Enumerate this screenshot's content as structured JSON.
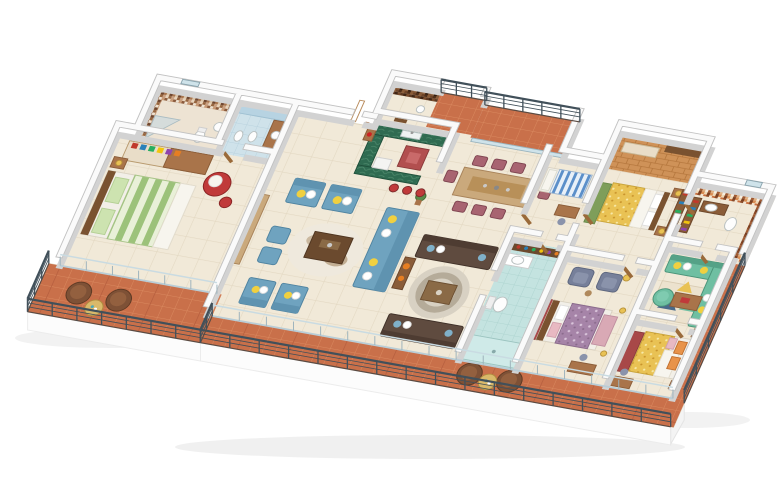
{
  "scene": {
    "title": "3D isometric apartment floor plan render",
    "background": "#ffffff",
    "palette": {
      "wallTop": "#fafafa",
      "wallEdge": "#c2c2c2",
      "wallSide": "#d2d2d2",
      "floorBeige": "#f1e9d8",
      "floorGrout": "#e3d8c2",
      "terracotta": "#c9704a",
      "terracottaLine": "#da8a60",
      "terracottaBig": "#b2593a",
      "aquaFloor": "#c4e3e0",
      "blueTile": "#cfe2ea",
      "railing": "#41505a",
      "glass": "#9fb4bd",
      "wood": "#a9744a",
      "woodDark": "#7a5230",
      "woodLight": "#caa97c",
      "cream": "#e9ddc8",
      "greenCounter": "#2f6b51",
      "redIsland": "#b24f4f",
      "applianceWhite": "#f4f4f2",
      "sofaBlue": "#6fa3bf",
      "sofaBlueDark": "#5f93b0",
      "sofaBrown": "#5f4b3f",
      "sofaBrownDark": "#4e3c32",
      "sofaTeal": "#6fbfa2",
      "sofaTealDark": "#55a287",
      "chairMaroon": "#a86471",
      "chairGray": "#77809a",
      "chairRed": "#c03a3a",
      "loungeBrown": "#7e5136",
      "patioTable": "#d9b96a",
      "bedGreenLight": "#e9f0d8",
      "bedGreenBand": "#9cc27a",
      "bedYellow": "#e9c254",
      "bedYellowDot": "#f7e9a8",
      "bedPurple": "#a684a8",
      "bedPurpleDot": "#d9c4da",
      "bedBlueStripe": "#5b8fc9",
      "bedBlueBase": "#e8f0f8",
      "pillowWhite": "#f7f5ee",
      "pillowYellow": "#f0d040",
      "pillowPink": "#e8b9c2",
      "pillowOrange": "#e8934a",
      "rugGreen": "#7e9e5a",
      "rugRed": "#a84848",
      "lampYellow": "#e9c254",
      "plantGreen": "#5a8a4a",
      "mosaicBrown": [
        "#c89a76",
        "#8a5a3c",
        "#efe3d2",
        "#a9764f",
        "#dcc5a8",
        "#6f4630",
        "#caa183",
        "#e8d4bc",
        "#96653f"
      ],
      "mosaicOrange": [
        "#f2e6d4",
        "#c96f3f",
        "#8a4a28",
        "#e0b184",
        "#f7efe2",
        "#a05a32",
        "#d98d54",
        "#efd9b8",
        "#7a3f22"
      ],
      "mosaicDark": [
        "#6e4428",
        "#4f2f1a",
        "#8a5c38",
        "#3f2413",
        "#7a4c2c",
        "#5d3922",
        "#936744",
        "#2f1b0e",
        "#845838"
      ],
      "shelfColors": [
        "#c0392b",
        "#2980b9",
        "#27ae60",
        "#f1c40f",
        "#8e44ad",
        "#e67e22"
      ]
    },
    "rooms": [
      {
        "id": "bathroom-left-mosaic",
        "label": "bathroom with brown mosaic tiles and glass shower"
      },
      {
        "id": "bathroom-left-blue",
        "label": "bathroom with light blue tiles"
      },
      {
        "id": "guest-bedroom",
        "label": "bedroom with green striped bed and red armchair"
      },
      {
        "id": "balcony-left",
        "label": "left balcony with round patio chairs"
      },
      {
        "id": "living-room",
        "label": "living room with blue sofa set"
      },
      {
        "id": "kitchen",
        "label": "kitchen with green counters and red island"
      },
      {
        "id": "utility-bathroom",
        "label": "utility bathroom with dark mosaic wall"
      },
      {
        "id": "kitchen-balcony",
        "label": "small service balcony"
      },
      {
        "id": "dining-room",
        "label": "dining room with eight maroon chairs"
      },
      {
        "id": "dining-balcony",
        "label": "balcony behind dining with glass sliders"
      },
      {
        "id": "family-lounge",
        "label": "lounge with two brown sofas and round rug"
      },
      {
        "id": "maid-room",
        "label": "small room with blue striped bed"
      },
      {
        "id": "central-bathroom",
        "label": "central bathroom with aqua floor"
      },
      {
        "id": "dressing-corridor",
        "label": "dressing corridor with parquet floor"
      },
      {
        "id": "bedroom-mid",
        "label": "bedroom with yellow patterned bed and green rug"
      },
      {
        "id": "sitting-nook",
        "label": "sitting nook with two gray armchairs"
      },
      {
        "id": "bedroom-purple",
        "label": "bedroom with purple patterned bed and pink chaise"
      },
      {
        "id": "bathroom-right",
        "label": "bathroom with orange mosaic walls"
      },
      {
        "id": "tv-lounge",
        "label": "lounge with teal sectional sofa"
      },
      {
        "id": "bedroom-right",
        "label": "bedroom with yellow bed and orange pillows"
      },
      {
        "id": "terrace",
        "label": "long terracotta terrace with dark railing"
      },
      {
        "id": "side-balcony",
        "label": "narrow right-side balcony"
      }
    ],
    "furniture": [
      "wardrobe",
      "bed-green",
      "armchair-red",
      "patio-set-1",
      "sofa-set-blue",
      "cowhide-rug",
      "coffee-table-living",
      "plant",
      "kitchen-counter",
      "kitchen-island",
      "bar-stools",
      "entry-door",
      "glass-doors-dining",
      "dining-set",
      "sofa-set-brown",
      "round-rug",
      "console-aquarium",
      "bed-blue-striped",
      "desk",
      "bottle-shelf",
      "vanity",
      "toilet",
      "shower",
      "bench-corridor",
      "closet-rod",
      "bed-yellow-mid",
      "shelf-colorful",
      "armchairs-gray",
      "bed-purple",
      "sofa-sectional-teal",
      "pouf-teal",
      "geometric-rug",
      "bed-yellow-right",
      "patio-set-2",
      "tv-unit"
    ]
  }
}
